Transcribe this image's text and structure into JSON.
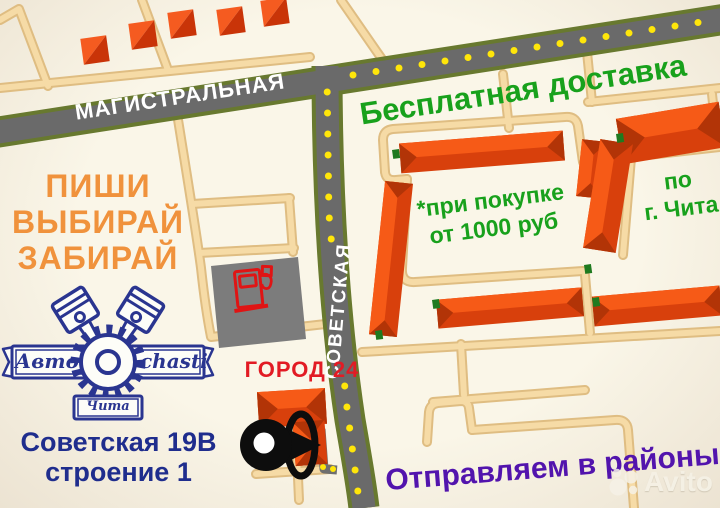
{
  "colors": {
    "bg": "#faf6e8",
    "green": "#18a11c",
    "orange": "#f0923c",
    "red": "#e21b24",
    "navy": "#1f2d8d",
    "purple": "#5214ad",
    "logo-navy": "#2a3590",
    "road-gray": "#6a6a6a",
    "road-olive": "#68792f",
    "tan": "#f6dba6",
    "tan-casing": "#dfbd82",
    "dot-yellow": "#ffe60a",
    "bld-bright": "#f65a17",
    "bld-dark": "#d8400c",
    "bld-end": "#b23407",
    "gas-gray": "#7c7c7c",
    "pump-red": "#e01414"
  },
  "streets": {
    "magistralnaya": "МАГИСТРАЛЬНАЯ",
    "sovetskaya": "СОВЕТСКАЯ"
  },
  "promo": {
    "free_delivery": "Бесплатная доставка",
    "condition_line1": "*при покупке",
    "condition_line2": "от 1000 руб",
    "area_line1": "по",
    "area_line2": "г. Чита",
    "cta_line1": "ПИШИ",
    "cta_line2": "ВЫБИРАЙ",
    "cta_line3": "ЗАБИРАЙ",
    "districts": "Отправляем в районы"
  },
  "location": {
    "landmark": "ГОРОД 24",
    "address_line1": "Советская 19В",
    "address_line2": "строение 1"
  },
  "logo": {
    "word_left": "Авто",
    "word_right": "chasti",
    "city": "Чита"
  },
  "watermark": "Avito"
}
